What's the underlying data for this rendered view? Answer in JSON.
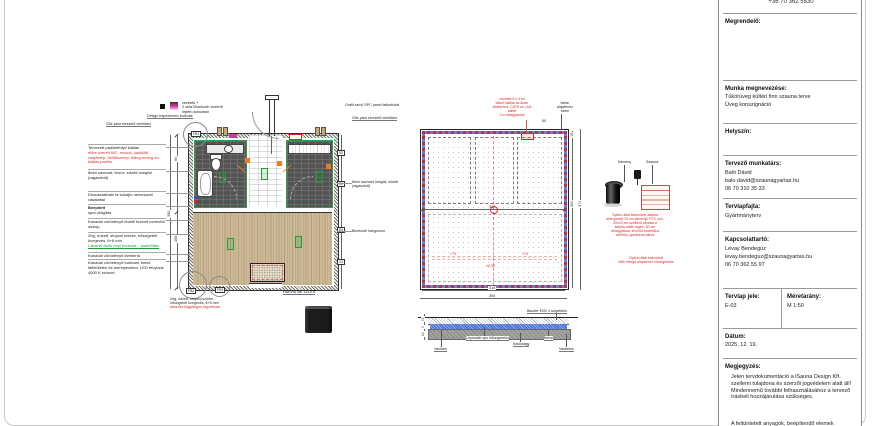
{
  "colors": {
    "annotation_red": "#d92b2b",
    "accent_green": "#1f9e3c",
    "accent_orange": "#ef7d1e",
    "insulation_blue": "#6b7bdc",
    "tile_dark": "#545454",
    "wood": "#cdb996",
    "magenta": "#d6359c"
  },
  "title_block": {
    "phone": "+36 70 362 5830",
    "client_label": "Megrendelő:",
    "work_label": "Munka megnevezése:",
    "work_line1": "Tükörüveg kültéri finn szauna terve",
    "work_line2": "Üveg konszignáció",
    "location_label": "Helyszín:",
    "designer_label": "Tervező munkatárs:",
    "designer_name": "Baló Dávid",
    "designer_email": "balo.david@szaunagyartas.hu",
    "designer_phone": "06 70 310 35 33",
    "sheet_type_label": "Tervlapfajta:",
    "sheet_type_value": "Gyártmányterv",
    "contact_label": "Kapcsolattartó:",
    "contact_name": "Lévay Bendegúz",
    "contact_email": "levay.bendeguz@szaunagyartas.hu",
    "contact_phone": "06 70 362 55 97",
    "sheet_id_label": "Tervlap jele:",
    "sheet_id_value": "E-03",
    "scale_label": "Méretarány:",
    "scale_value": "M 1:50",
    "date_label": "Dátum:",
    "date_value": "2025. 12. 19.",
    "notes_label": "Megjegyzés:",
    "notes_text": "Jelen tervdokumentáció a iSauna Design Kft. szellemi tulajdona és szerzői jogvédelem alatt áll! Mindennemű további felhasználásához a tervező írásbeli hozzájárulása szükséges.",
    "notes_text2": "A feltüntetett anyagok, beépítendő elemek"
  },
  "floor_plan": {
    "legend_line1": "vezeték +",
    "legend_line2": "2 utas Bluetooth vezérlő",
    "legend_line3": "rejtett dobozban",
    "top_label1": "Design trapézlemez burkolat",
    "top_label2": "Gőz-pára elvezető ventilátor",
    "top_right_label1": "Grafit színű SPC panel falburkolat",
    "top_right_label2": "Gőz-pára elvezető ventilátor",
    "left_label1_title": "Tervezett padlólefolyó kiállás",
    "left_label1_red": "előre szerelt WC, mosdó, kádtöltő csaptelep, öblítőszelep, hideg-meleg víz kiállás padlón",
    "left_label2": "8mm savmart, bronz, edzett üvegfal (ragasztott)",
    "left_label3": "Elcsúsztatható fa tolóajtó nemesacél vasalattal",
    "left_label4_title": "Beépített",
    "left_label4": "spot világítás",
    "left_label5": "Kanadai vörösfenyő lécből burkolt merevítő oszlop",
    "left_label6": "2rtg, edzett, stopsol szürke, hőszigetelt üvegezés, 6+6 mm",
    "left_label6_green": "Lábazat alatti vinyl burkolat – padlófűtés",
    "left_label7": "Kanadai vörösfenyő lambéria",
    "left_label8": "Kanadai vörösfenyő burkolat, belső falfelületen és mennyezeten, LED fénycsík 4000 K színnel",
    "right_label1": "8mm savmart üvegfal, edzett (ragasztott)",
    "right_label2": "Bluetooth hangszóró",
    "bottom_left_label": "2rtg, edzett, stopsol szürke, hőszigetelt üvegezés, 6+6 mm",
    "bottom_left_red": "abszolút függőleges rögzítéssel",
    "heater_label": "HARVIA Mb 133-KR",
    "tag_fb1": "FB1",
    "tag_fb2": "FB2",
    "tag_fb3": "FB3",
    "dim_left1": "84",
    "dim_left2": "268",
    "dim_left3": "350",
    "tag_r1": "53",
    "tag_r2": "29",
    "tag_r3": "83",
    "tag_r4": "13"
  },
  "foundation_plan": {
    "red_note_line1": "vezeték 5 x 4 es",
    "red_note_line2": "kábel kiállás az áram",
    "red_note_line3": "ellátáshoz, CAT6 os LAN kábel",
    "red_note_line4": "1m ráhagyással",
    "edge_label_line1": "beton",
    "edge_label_line2": "alaplemez",
    "edge_label_line3": "széle",
    "dim_50": "50",
    "dim_mid": "340",
    "dim_bottom_inner": "318",
    "dim_bottom_outer": "354",
    "dim_right_inner": "302",
    "dim_right_outer": "371",
    "dim_corner": "18",
    "mark_left": "+73",
    "mark_right": "+73",
    "level_mark": "±0,00"
  },
  "section_detail": {
    "label_top": "Bauder ENV 4 szigetelés",
    "label_mesh": "Vasháló",
    "label_xps": "Lépésálló xps hőszigetelés",
    "label_gravel": "Kavicságy",
    "label_concrete": "Beton",
    "label_rc": "Vasbeton",
    "dim1": "15",
    "dim2": "5",
    "dim3": "10"
  },
  "flue_detail": {
    "label_chimney": "Kémény",
    "label_sauna": "Szauna",
    "red_note1_line1": "Gyártó által biztosított, alapba",
    "red_note1_line2": "elhelyezett 15 cm átmérőjű PVC cső,",
    "red_note1_line3": "20x20 cm szellőző ráccsal a",
    "red_note1_line4": "kályha alatti végén, 50 cm",
    "red_note1_line5": "ráhagyással, kívülről esztétikus",
    "red_note1_line6": "szellőző gombával zárva",
    "red_note2_line1": "Gyártó által biztosított",
    "red_note2_line2": "több rétegű alaplemez hőszigetelés"
  }
}
